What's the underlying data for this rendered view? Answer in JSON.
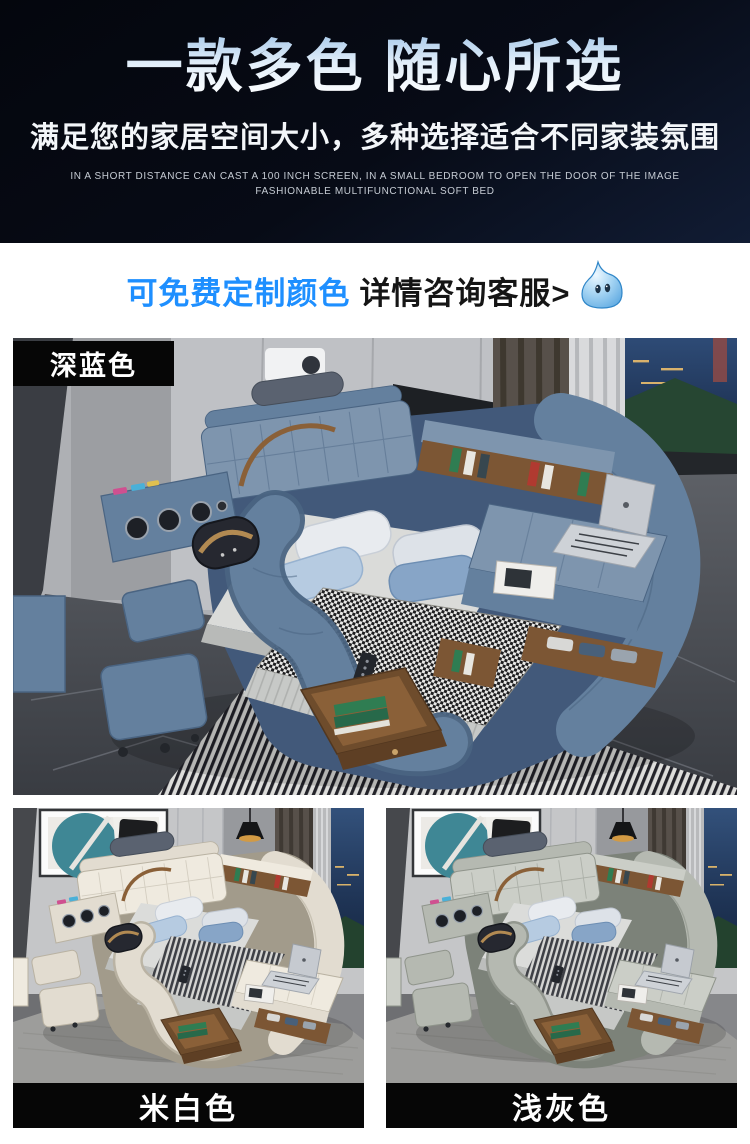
{
  "header": {
    "title": "一款多色 随心所选",
    "subtitle": "满足您的家居空间大小，多种选择适合不同家装氛围",
    "caption_line1": "IN A SHORT DISTANCE CAN CAST A 100 INCH SCREEN, IN A SMALL BEDROOM TO OPEN THE DOOR OF THE IMAGE",
    "caption_line2": "FASHIONABLE MULTIFUNCTIONAL SOFT BED"
  },
  "notice": {
    "highlight": "可免费定制颜色",
    "text": "详情咨询客服>",
    "highlight_color": "#1e8fff",
    "icon": "chat-bubble-mascot-icon"
  },
  "products": [
    {
      "label": "深蓝色",
      "swatch": "#6884a4",
      "palette": {
        "base": "#64809e",
        "light": "#7e95ae",
        "dark": "#4a6482",
        "deep": "#42597a"
      }
    },
    {
      "label": "米白色",
      "swatch": "#e6e0d4",
      "palette": {
        "base": "#e2dcd0",
        "light": "#efeadf",
        "dark": "#b9b2a2",
        "deep": "#a29b8b"
      }
    },
    {
      "label": "浅灰色",
      "swatch": "#b9bdb5",
      "palette": {
        "base": "#b5b9b1",
        "light": "#cbcec7",
        "dark": "#8f948b",
        "deep": "#7c8279"
      }
    }
  ],
  "colors": {
    "hero_bg": "#070b15",
    "accent_blue": "#1e8fff",
    "label_bg": "#060606",
    "label_text": "#ffffff"
  }
}
